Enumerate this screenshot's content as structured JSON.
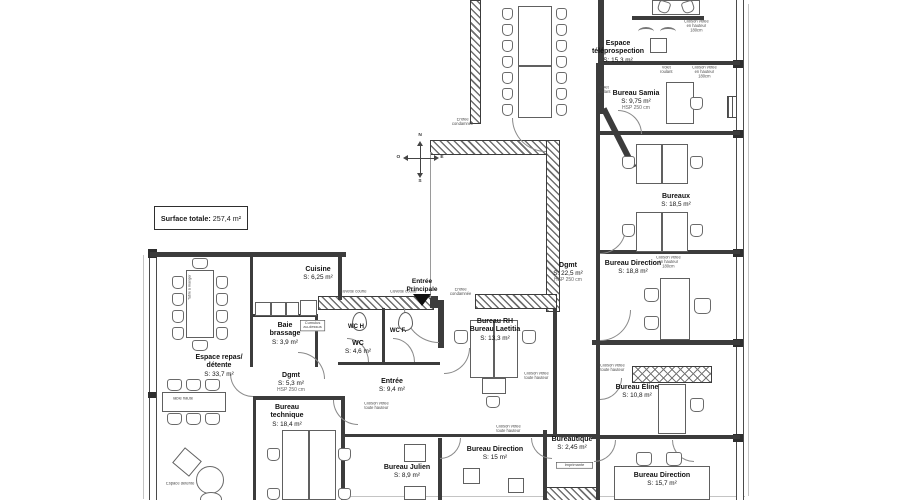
{
  "title_box": {
    "label": "Surface totale:",
    "value": "257,4 m²"
  },
  "compass": {
    "n": "N",
    "s": "S",
    "e": "E",
    "o": "O"
  },
  "entrance": {
    "line1": "Entrée",
    "line2": "Principale"
  },
  "rooms": {
    "teleprospection": {
      "name": "Espace téléprospection",
      "area": "S: 15,3 m²"
    },
    "samia": {
      "name": "Bureau Samia",
      "area": "S: 9,75 m²",
      "note": "HSP 250 cm"
    },
    "bureaux": {
      "name": "Bureaux",
      "area": "S: 18,5 m²"
    },
    "direction1": {
      "name": "Bureau Direction",
      "area": "S: 18,8 m²"
    },
    "eline": {
      "name": "Bureau Éline",
      "area": "S: 10,8 m²"
    },
    "direction2": {
      "name": "Bureau Direction",
      "area": "S: 15,7 m²"
    },
    "dgmt1": {
      "name": "Dgmt",
      "area": "S: 22,5 m²",
      "note": "HSP 250 cm"
    },
    "rh": {
      "name1": "Bureau RH",
      "name2": "Bureau Laetitia",
      "area": "S: 13,3 m²"
    },
    "entree_hall": {
      "name": "Entrée",
      "area": "S: 9,4 m²"
    },
    "cuisine": {
      "name": "Cuisine",
      "area": "S: 6,25 m²"
    },
    "baie": {
      "name1": "Baie",
      "name2": "brassage",
      "area": "S: 3,9 m²"
    },
    "wc_h": {
      "name": "WC H"
    },
    "wc_f": {
      "name": "WC F."
    },
    "wc": {
      "name": "WC",
      "area": "S: 4,6 m²"
    },
    "dgmt2": {
      "name": "Dgmt",
      "area": "S: 5,3 m²",
      "note": "HSP 250 cm"
    },
    "repas": {
      "name1": "Espace repas/",
      "name2": "détente",
      "area": "S: 33,7 m²"
    },
    "technique": {
      "name1": "Bureau",
      "name2": "technique",
      "area": "S: 18,4 m²"
    },
    "julien": {
      "name": "Bureau Julien",
      "area": "S: 8,9 m²"
    },
    "direction3": {
      "name": "Bureau Direction",
      "area": "S: 15 m²"
    },
    "bureautique": {
      "name": "Bureautique",
      "area": "S: 2,45 m²"
    }
  },
  "annotations": {
    "cloison_180_a": "Cloison vitrée",
    "cloison_180_b": "en hauteur",
    "cloison_180_c": "180cm",
    "cloison_th_a": "Cloison vitrée",
    "cloison_th_b": "toute hauteur",
    "volet_a": "Volet",
    "volet_b": "roulant",
    "condamnee_a": "Entrée",
    "condamnee_b": "condamnée",
    "cuvette": "Cuvette courte",
    "imprimante": "Imprimante",
    "table_haute": "Table haute",
    "table_manger": "Table à manger",
    "espace_detente": "Espace détente",
    "cumulus_a": "Cumulus",
    "cumulus_b": "au-dessus"
  },
  "colors": {
    "wall": "#3c3c3c",
    "paper": "#ffffff",
    "ink": "#1a1a1a"
  }
}
